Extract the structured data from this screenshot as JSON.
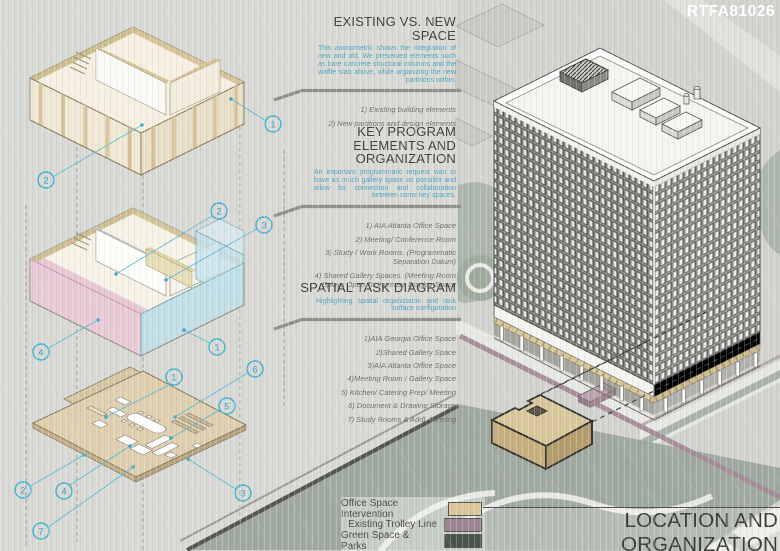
{
  "board": {
    "code": "RTFA81026",
    "title": "LOCATION AND ORGANIZATION"
  },
  "sections": [
    {
      "heading": "EXISTING VS. NEW SPACE",
      "description": "This axonometric shows the integration of new and old. We preserved elements such as bare concrete structural columns and the waffle slab above, while organizing the new partitions within.",
      "items": [
        "1) Existing building elements",
        "2) New partitions and design elements"
      ]
    },
    {
      "heading": "KEY PROGRAM ELEMENTS AND ORGANIZATION",
      "description": "An important programmatic request was to have as much gallery space as possible and allow for connection and collaboration between some key spaces.",
      "items": [
        "1) AIA Atlanta Office Space",
        "2) Meeting/ Conference Room",
        "3) Study / Work Rooms. (Programmatic Separation Datum)",
        "4) Shared Gallery Spaces. (Meeting Room Splays Open To Increase Display Space"
      ]
    },
    {
      "heading": "SPATIAL TASK DIAGRAM",
      "description": "Highlighting spatial organization and task surface configuration",
      "items": [
        "1)AIA Georgia Office Space",
        "2)Shared Gallery Space",
        "3)AIA Atlanta Office Space",
        "4)Meeting Room / Gallery Space",
        "5) Kitchen/ Catering Prep/ Meeting",
        "6) Document & Drawing Storage",
        "7) Study Rooms & Addl. Meeting"
      ]
    }
  ],
  "legend": {
    "items": [
      {
        "label": "Office Space Intervention",
        "color": "#d9c699"
      },
      {
        "label": "Existing Trolley Line",
        "color": "#9a8590"
      },
      {
        "label": "Green Space & Parks",
        "color": "#49534c"
      }
    ]
  },
  "diagrams": {
    "axon1": {
      "callouts": [
        "1",
        "2"
      ]
    },
    "axon2": {
      "callouts": [
        "1",
        "2",
        "3",
        "4"
      ]
    },
    "axon3": {
      "callouts": [
        "1",
        "2",
        "3",
        "4",
        "5",
        "6",
        "7"
      ]
    }
  },
  "colors": {
    "accent_blue": "#52a5c4",
    "callout_cyan": "#3fb0d0",
    "heading_gray": "#3d3d3c",
    "intervention_tan": "#d9c699",
    "trolley_mauve": "#9a8590",
    "parks_green": "#49534c"
  }
}
